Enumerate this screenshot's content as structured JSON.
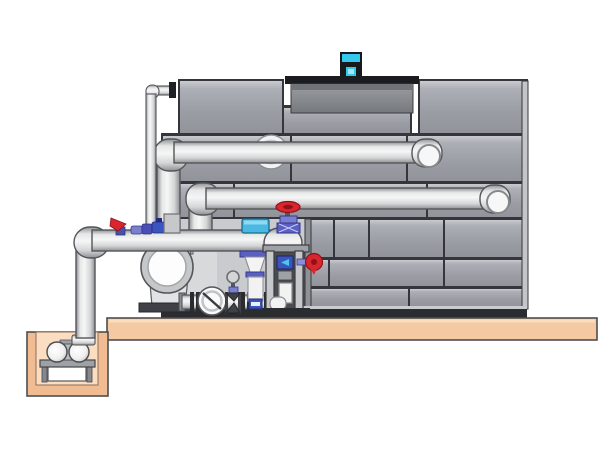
{
  "scene": {
    "title": "Cooling tower with pump skid and sump pit - technical illustration",
    "background": "#FFFFFF"
  },
  "colors": {
    "white": "#FFFFFF",
    "panel_face": "#A4A7AD",
    "panel_light": "#C3C5C9",
    "seam": "#34363B",
    "bay": "#C9CBCE",
    "bay_rail": "#B4B6B9",
    "bay_frame": "#8E9196",
    "bay_shadow": "#55575C",
    "base_bar": "#2A2C2F",
    "rim": "#1A1C1F",
    "motor_cyan": "#35C8EC",
    "motor_dark": "#17191C",
    "pipe_outline": "#53555A",
    "pipe_face": "#F4F4F4",
    "platform": "#F5C9A2",
    "platform_hi": "#FBE0C4",
    "platform_line": "#4C4E50",
    "pit_wall": "#F1BC92",
    "pit_inner": "#FBDDC2",
    "red": "#D9252E",
    "red_dark": "#8E1318",
    "blue": "#5A5FC4",
    "blue_dark": "#343A8C",
    "blue_light": "#7B7FD0",
    "device_blue": "#3A55C0",
    "cyan": "#49B9E2",
    "cyan_light": "#8FD9F2",
    "steel": "#3F4146",
    "steel_mid": "#9EA1A6",
    "steel_light": "#C6C8CB"
  },
  "components": [
    {
      "id": "cooling-tower",
      "label": "Cooling tower casing with panel walls"
    },
    {
      "id": "fan-shroud",
      "label": "Fan shroud on tower deck"
    },
    {
      "id": "fan-motor",
      "label": "Cyan fan motor"
    },
    {
      "id": "upper-return-pipe",
      "label": "Upper return pipe with riser and elbow"
    },
    {
      "id": "lower-return-pipe",
      "label": "Lower return pipe with riser and elbow"
    },
    {
      "id": "makeup-water-pipe",
      "label": "Make-up water pipe"
    },
    {
      "id": "platform",
      "label": "Equipment platform slab"
    },
    {
      "id": "sump-pit",
      "label": "Sump pit"
    },
    {
      "id": "sump-pump",
      "label": "Submersible sump pump on stand"
    },
    {
      "id": "suction-pipe",
      "label": "Pump suction pipe from sump"
    },
    {
      "id": "centrifugal-pump",
      "label": "Centrifugal pump with circular inlet"
    },
    {
      "id": "pipe-fittings",
      "label": "Small valves and fittings on suction pipe"
    },
    {
      "id": "low-level-pipe",
      "label": "Low level skid pipe with flanges"
    },
    {
      "id": "check-valve",
      "label": "Swing check valve"
    },
    {
      "id": "control-valve",
      "label": "Control valve column with cyan actuator"
    },
    {
      "id": "instrument-stand",
      "label": "Instrument stand with flow device"
    },
    {
      "id": "red-gate-valve",
      "label": "Gate valve with red handwheel"
    },
    {
      "id": "side-handwheel-valve",
      "label": "Side valve with red handwheel"
    },
    {
      "id": "equipment-bay",
      "label": "Open equipment bay of tower"
    },
    {
      "id": "small-gate-valve",
      "label": "Small gate valve with handwheel"
    }
  ]
}
